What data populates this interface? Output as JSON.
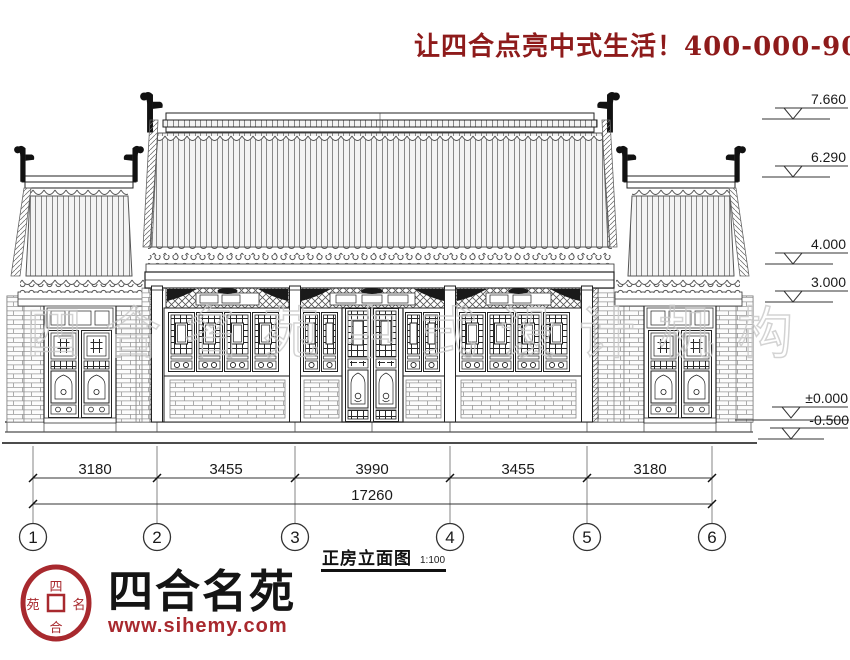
{
  "header": {
    "slogan": "让四合点亮中式生活！400-000-9075"
  },
  "watermark": {
    "text": "四合名苑中式设计机构"
  },
  "drawing": {
    "caption": {
      "title": "正房立面图",
      "scale": "1:100"
    },
    "elevations": [
      {
        "value": "7.660"
      },
      {
        "value": "6.290"
      },
      {
        "value": "4.000"
      },
      {
        "value": "3.000"
      },
      {
        "value": "±0.000"
      },
      {
        "value": "-0.500"
      }
    ],
    "dimensions": {
      "segments": [
        "3180",
        "3455",
        "3990",
        "3455",
        "3180"
      ],
      "total": "17260"
    },
    "axes": [
      "1",
      "2",
      "3",
      "4",
      "5",
      "6"
    ]
  },
  "logo": {
    "name": "四合名苑",
    "url": "www.sihemy.com",
    "seal": {
      "top": "四",
      "bottom": "合",
      "right": "名",
      "left": "苑"
    }
  },
  "colors": {
    "slogan_red": "#8e1b1b",
    "logo_red": "#a8292e",
    "line_black": "#222222",
    "watermark_gray": "#c9c9c9"
  }
}
